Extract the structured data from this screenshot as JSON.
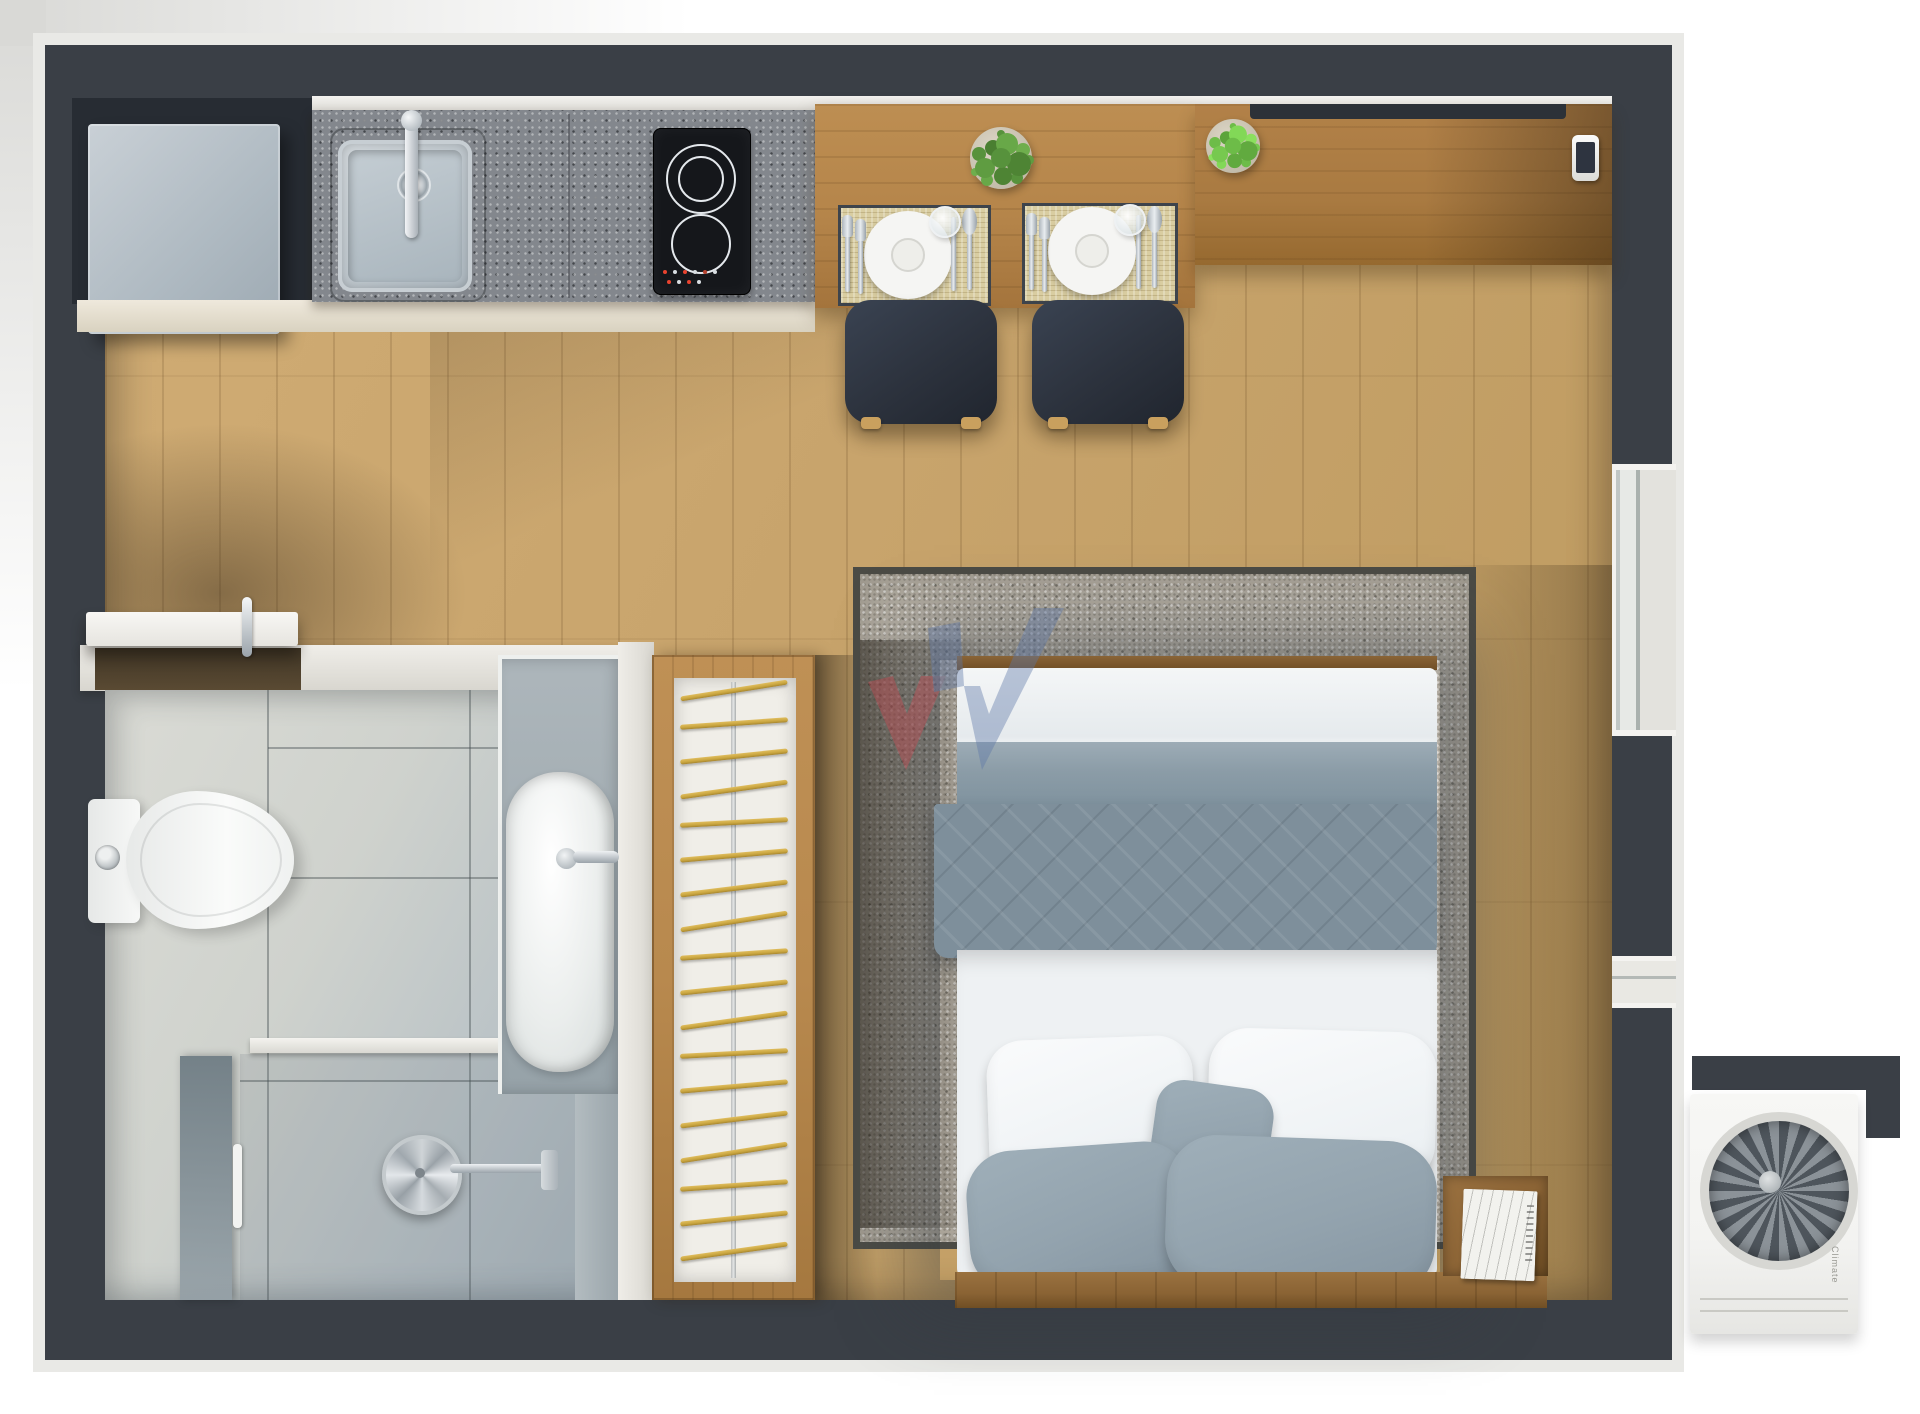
{
  "scene": {
    "label": "Studio apartment floor plan - 3D top-down render",
    "rooms": [
      "kitchen",
      "living-dining",
      "bathroom",
      "bedroom"
    ]
  },
  "palette": {
    "wall": "#3a3f46",
    "wall_trim": "#e9e9e6",
    "floor": "#c8a46c",
    "table_wood": "#b5854a",
    "sideboard_wood": "#a97a41",
    "granite": "#83878d",
    "cream_cabinet": "#e6dfd0",
    "fridge": "#b6c0c8",
    "cooktop": "#15171b",
    "chair": "#2c323d",
    "placemat": "#d9cda1",
    "plate": "#f5f5f3",
    "plant_dark": "#57923c",
    "plant_light": "#8aba52",
    "rug": "#b5afa4",
    "rug_border": "#4b4b45",
    "duvet": "#7e8f9b",
    "duvet_flat": "#8b9ca7",
    "sheet": "#eef1f3",
    "pillow_gray": "#93a3ae",
    "headboard": "#8a6334",
    "nightstand": "#8d6536",
    "tile": "#cfd2cd",
    "sanitary_white": "#f4f6f5",
    "counter_gray": "#a2adb3",
    "shower_glass": "#8796a0",
    "closet_wood": "#b8894e",
    "hanger_gold": "#c9a53f",
    "watermark_red": "#c34a52",
    "watermark_blue": "#5d77a8",
    "ac_body": "#f3f3f1",
    "window_light": "#eceae7"
  },
  "closet": {
    "hanger_count": 18
  },
  "dining": {
    "place_setting_count": 2,
    "chair_count": 2,
    "plant_count": 2
  },
  "bed": {
    "white_pillow_count": 2,
    "gray_pillow_count": 3
  },
  "ac_unit": {
    "brand_label": "Climate"
  },
  "watermark": {
    "letter": "W"
  }
}
